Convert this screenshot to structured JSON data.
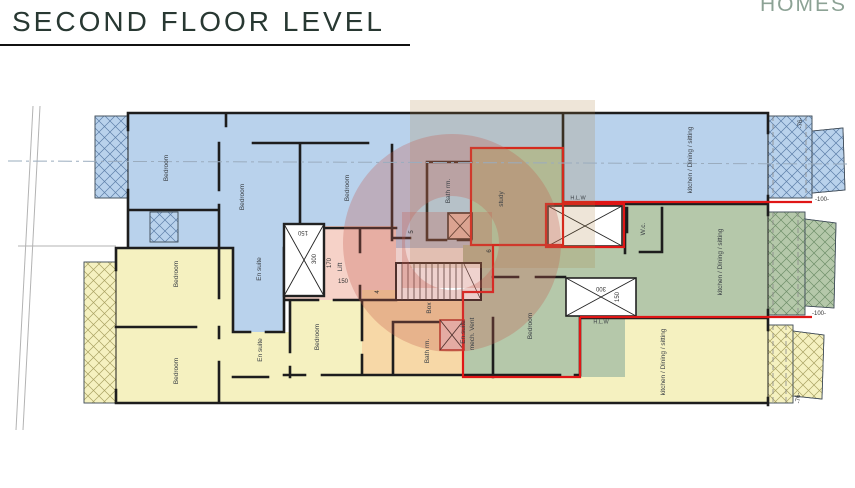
{
  "header": {
    "title": "SECOND FLOOR LEVEL",
    "brand": "HOMES"
  },
  "plan": {
    "rooms": [
      {
        "text": "Bedroom"
      },
      {
        "text": "Bedroom"
      },
      {
        "text": "Bedroom"
      },
      {
        "text": "Bath rm."
      },
      {
        "text": "study"
      },
      {
        "text": "kitchen / Dining / sitting"
      },
      {
        "text": "H.L.W"
      },
      {
        "text": "W.c."
      },
      {
        "text": "kitchen / Dining / sitting"
      },
      {
        "text": "Bedroom"
      },
      {
        "text": "En.suite"
      },
      {
        "text": "mech. Vent"
      },
      {
        "text": "H.L.W"
      },
      {
        "text": "En suite"
      },
      {
        "text": "Bedroom"
      },
      {
        "text": "Bedroom"
      },
      {
        "text": "En suite"
      },
      {
        "text": "Bedroom"
      },
      {
        "text": "Box"
      },
      {
        "text": "Bath rm."
      },
      {
        "text": "kitchen / Dining / sitting"
      },
      {
        "text": "Lift"
      }
    ],
    "dims": [
      {
        "text": "150"
      },
      {
        "text": "300"
      },
      {
        "text": "170"
      },
      {
        "text": "150"
      },
      {
        "text": "4"
      },
      {
        "text": "5"
      },
      {
        "text": "6"
      },
      {
        "text": "300"
      },
      {
        "text": "150"
      },
      {
        "text": "-76-"
      },
      {
        "text": "-100-"
      },
      {
        "text": "-100-"
      },
      {
        "text": "-76-"
      }
    ]
  },
  "colors": {
    "unit_blue": "#b9d2ec",
    "unit_green": "#b5c8aa",
    "unit_yellow": "#f5f1c0",
    "core_pink": "#f6d2c8",
    "box_orange": "#f7d8a7",
    "outline_red": "#e01616",
    "wall": "#1d1d1d",
    "title_text": "#283832",
    "brand_text": "#8ca295"
  }
}
